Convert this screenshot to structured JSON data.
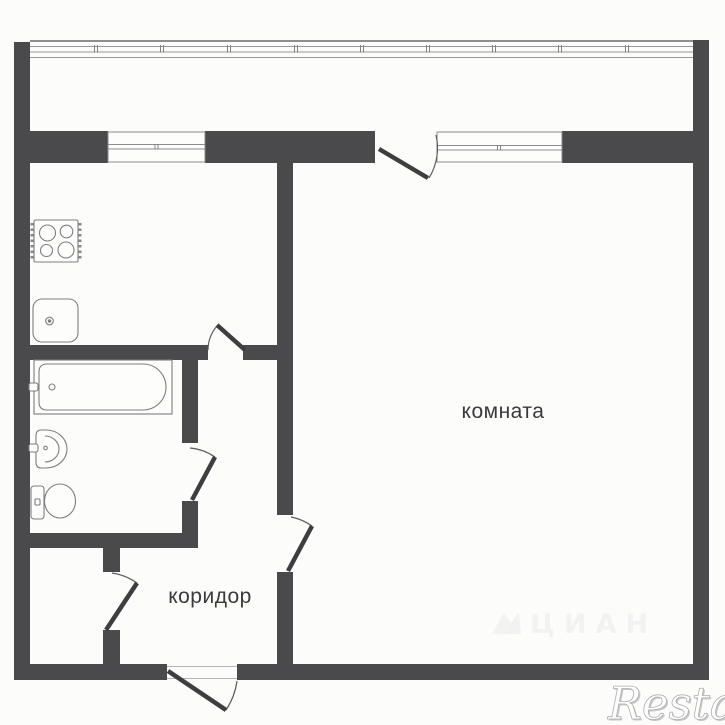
{
  "page": {
    "type": "apartment-floor-plan",
    "description": "One-room apartment floor plan with balcony"
  },
  "labels": {
    "room": "комната",
    "corridor": "коридор"
  },
  "watermarks": {
    "brand": "Restate",
    "portal": "ЦИАН"
  },
  "rooms": [
    {
      "id": "room",
      "label": "комната",
      "features": [
        "window",
        "balcony-door"
      ]
    },
    {
      "id": "kitchen",
      "label": "",
      "features": [
        "window"
      ],
      "fixtures": [
        "stove",
        "sink"
      ]
    },
    {
      "id": "bathroom",
      "label": "",
      "fixtures": [
        "bathtub",
        "washbasin",
        "toilet"
      ]
    },
    {
      "id": "corridor",
      "label": "коридор",
      "features": [
        "entry-door"
      ]
    },
    {
      "id": "closet",
      "label": ""
    },
    {
      "id": "balcony",
      "label": "",
      "features": [
        "glazing"
      ]
    }
  ],
  "colors": {
    "wall": "#4a4a4d",
    "background": "#fcfcfb",
    "fixture_line": "#7e7e81",
    "window_line": "#8b8b8e",
    "label_text": "#3a3a3c"
  }
}
